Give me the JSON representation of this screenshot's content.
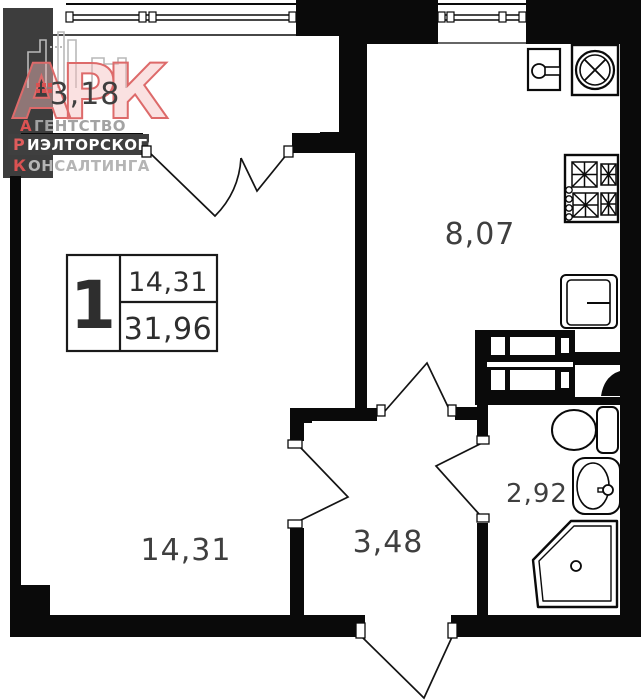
{
  "company_logo": {
    "monogram": "АРК",
    "lines": [
      {
        "initial": "А",
        "rest": "ГЕНТСТВО"
      },
      {
        "initial": "Р",
        "rest": "ИЭЛТОРСКОГО"
      },
      {
        "initial": "К",
        "rest": "ОНСАЛТИНГА"
      }
    ]
  },
  "apartment_info": {
    "rooms_count": "1",
    "living_area": "14,31",
    "total_area": "31,96"
  },
  "room_areas": {
    "balcony": "3,18",
    "kitchen": "8,07",
    "living_room": "14,31",
    "hallway": "3,48",
    "bathroom": "2,92"
  },
  "fixtures": [
    "kitchen-sink",
    "washing-machine",
    "stove",
    "refrigerator",
    "toilet",
    "wash-basin",
    "shower-cabin",
    "ventilation-shaft"
  ],
  "colors": {
    "wall": "#0a0a0a",
    "neighbor_section": "#3d3d3d",
    "label_text": "#3f3f3f",
    "brand_red": "#d95252",
    "brand_gray": "#a3a3a3",
    "brand_box": "#3f3f3f"
  }
}
